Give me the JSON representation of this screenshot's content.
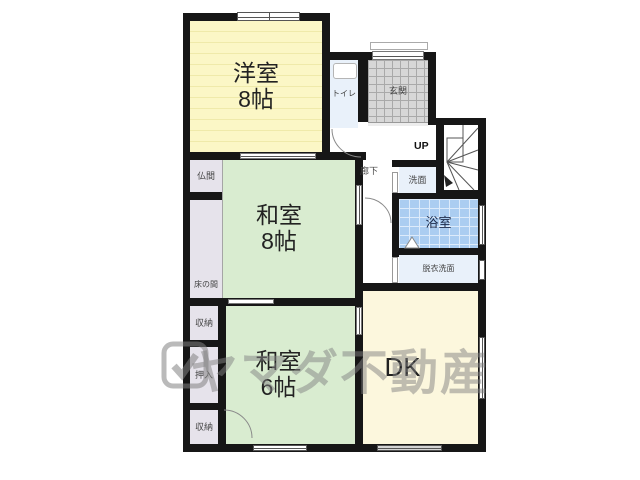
{
  "watermark": {
    "text": "ヤマダ不動産"
  },
  "rooms": {
    "yoshitsu": {
      "name": "洋室",
      "size": "8帖"
    },
    "washitsu8": {
      "name": "和室",
      "size": "8帖"
    },
    "washitsu6": {
      "name": "和室",
      "size": "6帖"
    },
    "dk": {
      "name": "DK"
    },
    "toilet": {
      "name": "トイレ"
    },
    "genkan": {
      "name": "玄関"
    },
    "rouka": {
      "name": "廊下"
    },
    "senmen": {
      "name": "洗面"
    },
    "yokushitsu": {
      "name": "浴室"
    },
    "datsui": {
      "name": "脱衣洗面"
    },
    "butsuma": {
      "name": "仏間"
    },
    "tokonoma": {
      "name": "床の間"
    },
    "shuno_top": {
      "name": "収納"
    },
    "oshiire": {
      "name": "押入"
    },
    "shuno_bottom": {
      "name": "収納"
    },
    "stairs": {
      "label": "UP"
    }
  },
  "colors": {
    "wall": "#161616",
    "western_room": "#fbf7c6",
    "tatami_room": "#d9ecd0",
    "dk_room": "#fcf7dd",
    "wet_room": "#e9f1fa",
    "bath": "#abcdf1",
    "entrance": "#d7d7d7",
    "closet": "#e6e3eb",
    "watermark": "rgba(130,130,130,0.5)"
  }
}
